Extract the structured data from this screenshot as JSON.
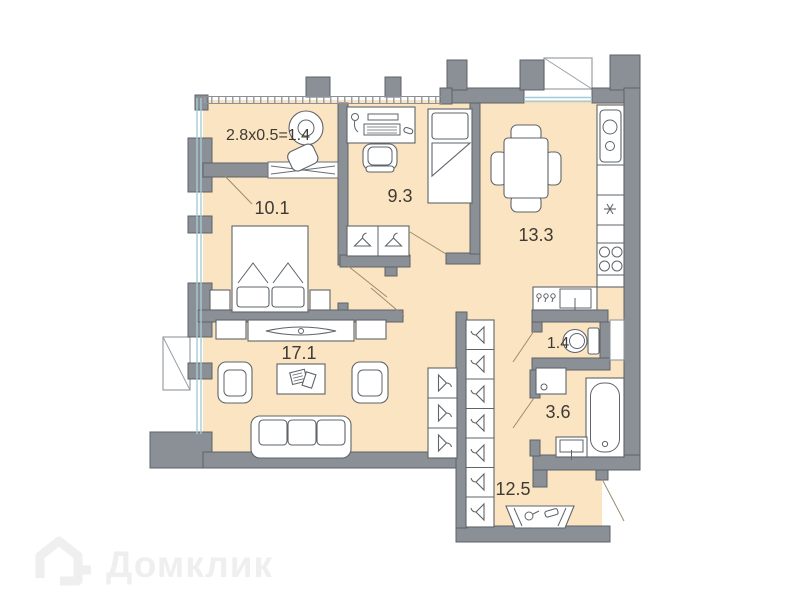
{
  "watermark": {
    "brand": "Домклик"
  },
  "rooms": {
    "balcony": {
      "label": "2.8x0.5=1.4"
    },
    "bedroom": {
      "area": "10.1"
    },
    "bedroom2": {
      "area": "9.3"
    },
    "kitchen": {
      "area": "13.3"
    },
    "living_room": {
      "area": "17.1"
    },
    "wc": {
      "area": "1.4"
    },
    "bathroom": {
      "area": "3.6"
    },
    "hallway": {
      "area": "12.5"
    }
  },
  "colors": {
    "room_fill": "#fbe4c1",
    "wall_fill": "#8b9097",
    "wall_stroke": "#5d6268",
    "furniture_stroke": "#5f646a",
    "door_leaf": "#9b8b72",
    "glass": "#a5ccd6",
    "label_text": "#3f3a35",
    "watermark": "#efefef"
  }
}
